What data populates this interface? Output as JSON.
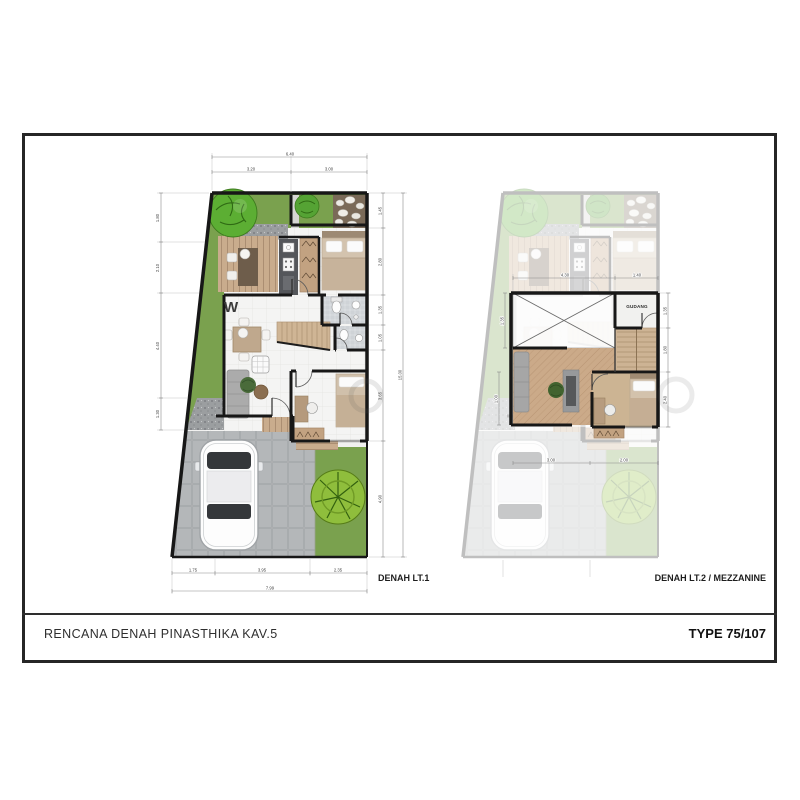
{
  "document": {
    "title_block_left": "RENCANA DENAH PINASTHIKA KAV.5",
    "title_block_right": "TYPE 75/107"
  },
  "plans": {
    "lt1": {
      "label": "DENAH LT.1",
      "watermark": "W",
      "dims": {
        "top_total": "6.40",
        "top_segs": [
          "3.20",
          "3.00"
        ],
        "left": [
          "1.80",
          "2.10",
          "4.40",
          "1.30"
        ],
        "right": [
          "1.45",
          "2.80",
          "1.35",
          "1.05",
          "3.65",
          "4.90"
        ],
        "right_total": "15.00",
        "bottom_segs": [
          "1.75",
          "3.95",
          "2.35"
        ],
        "bottom_total": "7.99"
      }
    },
    "lt2": {
      "label": "DENAH LT.2 / MEZZANINE",
      "gudang_label": "GUDANG",
      "dims": {
        "top_segs": [
          "4.30",
          "1.40"
        ],
        "right": [
          "1.35",
          "1.80",
          "2.40"
        ],
        "left": [
          "1.35",
          "1.00"
        ],
        "bottom_segs": [
          "3.00",
          "2.00"
        ]
      }
    }
  },
  "colors": {
    "wall": "#171717",
    "grass": "#7aa14e",
    "wood": "#c9ac8d",
    "herringbone": "#cbaa89",
    "paving": "#b7babc",
    "tree": "#5ca632",
    "title": "#2e2e2e"
  }
}
